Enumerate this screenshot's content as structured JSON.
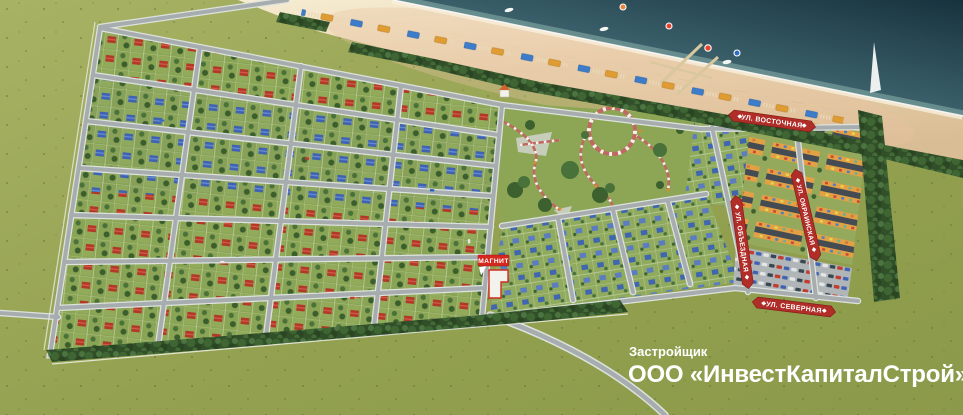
{
  "map": {
    "title": "seaside-settlement-master-plan",
    "streets": {
      "vostochnaya": "УЛ. ВОСТОЧНАЯ",
      "okrainskaya": "УЛ. ОКРАИНСКАЯ",
      "obyezdnaya": "УЛ. ОБЪЕЗДНАЯ",
      "severnaya": "УЛ. СЕВЕРНАЯ"
    },
    "poi": {
      "store_label": "МАГНИТ"
    },
    "developer": {
      "caption": "Застройщик",
      "name": "ООО «ИнвестКапиталСтрой»"
    },
    "colors": {
      "sea_deep": "#17323d",
      "sea_shallow": "#7ea9a4",
      "sand_light": "#f6ecd2",
      "sand_dark": "#d9bd94",
      "field_green": "#93a150",
      "forest_green": "#31502a",
      "road_gray": "#a7acaf",
      "banner_red": "#b02d28",
      "magnit_red": "#d5281e",
      "roof_red": "#b23828",
      "roof_blue": "#3f63b2",
      "townhouse_orange": "#e2a144"
    }
  }
}
